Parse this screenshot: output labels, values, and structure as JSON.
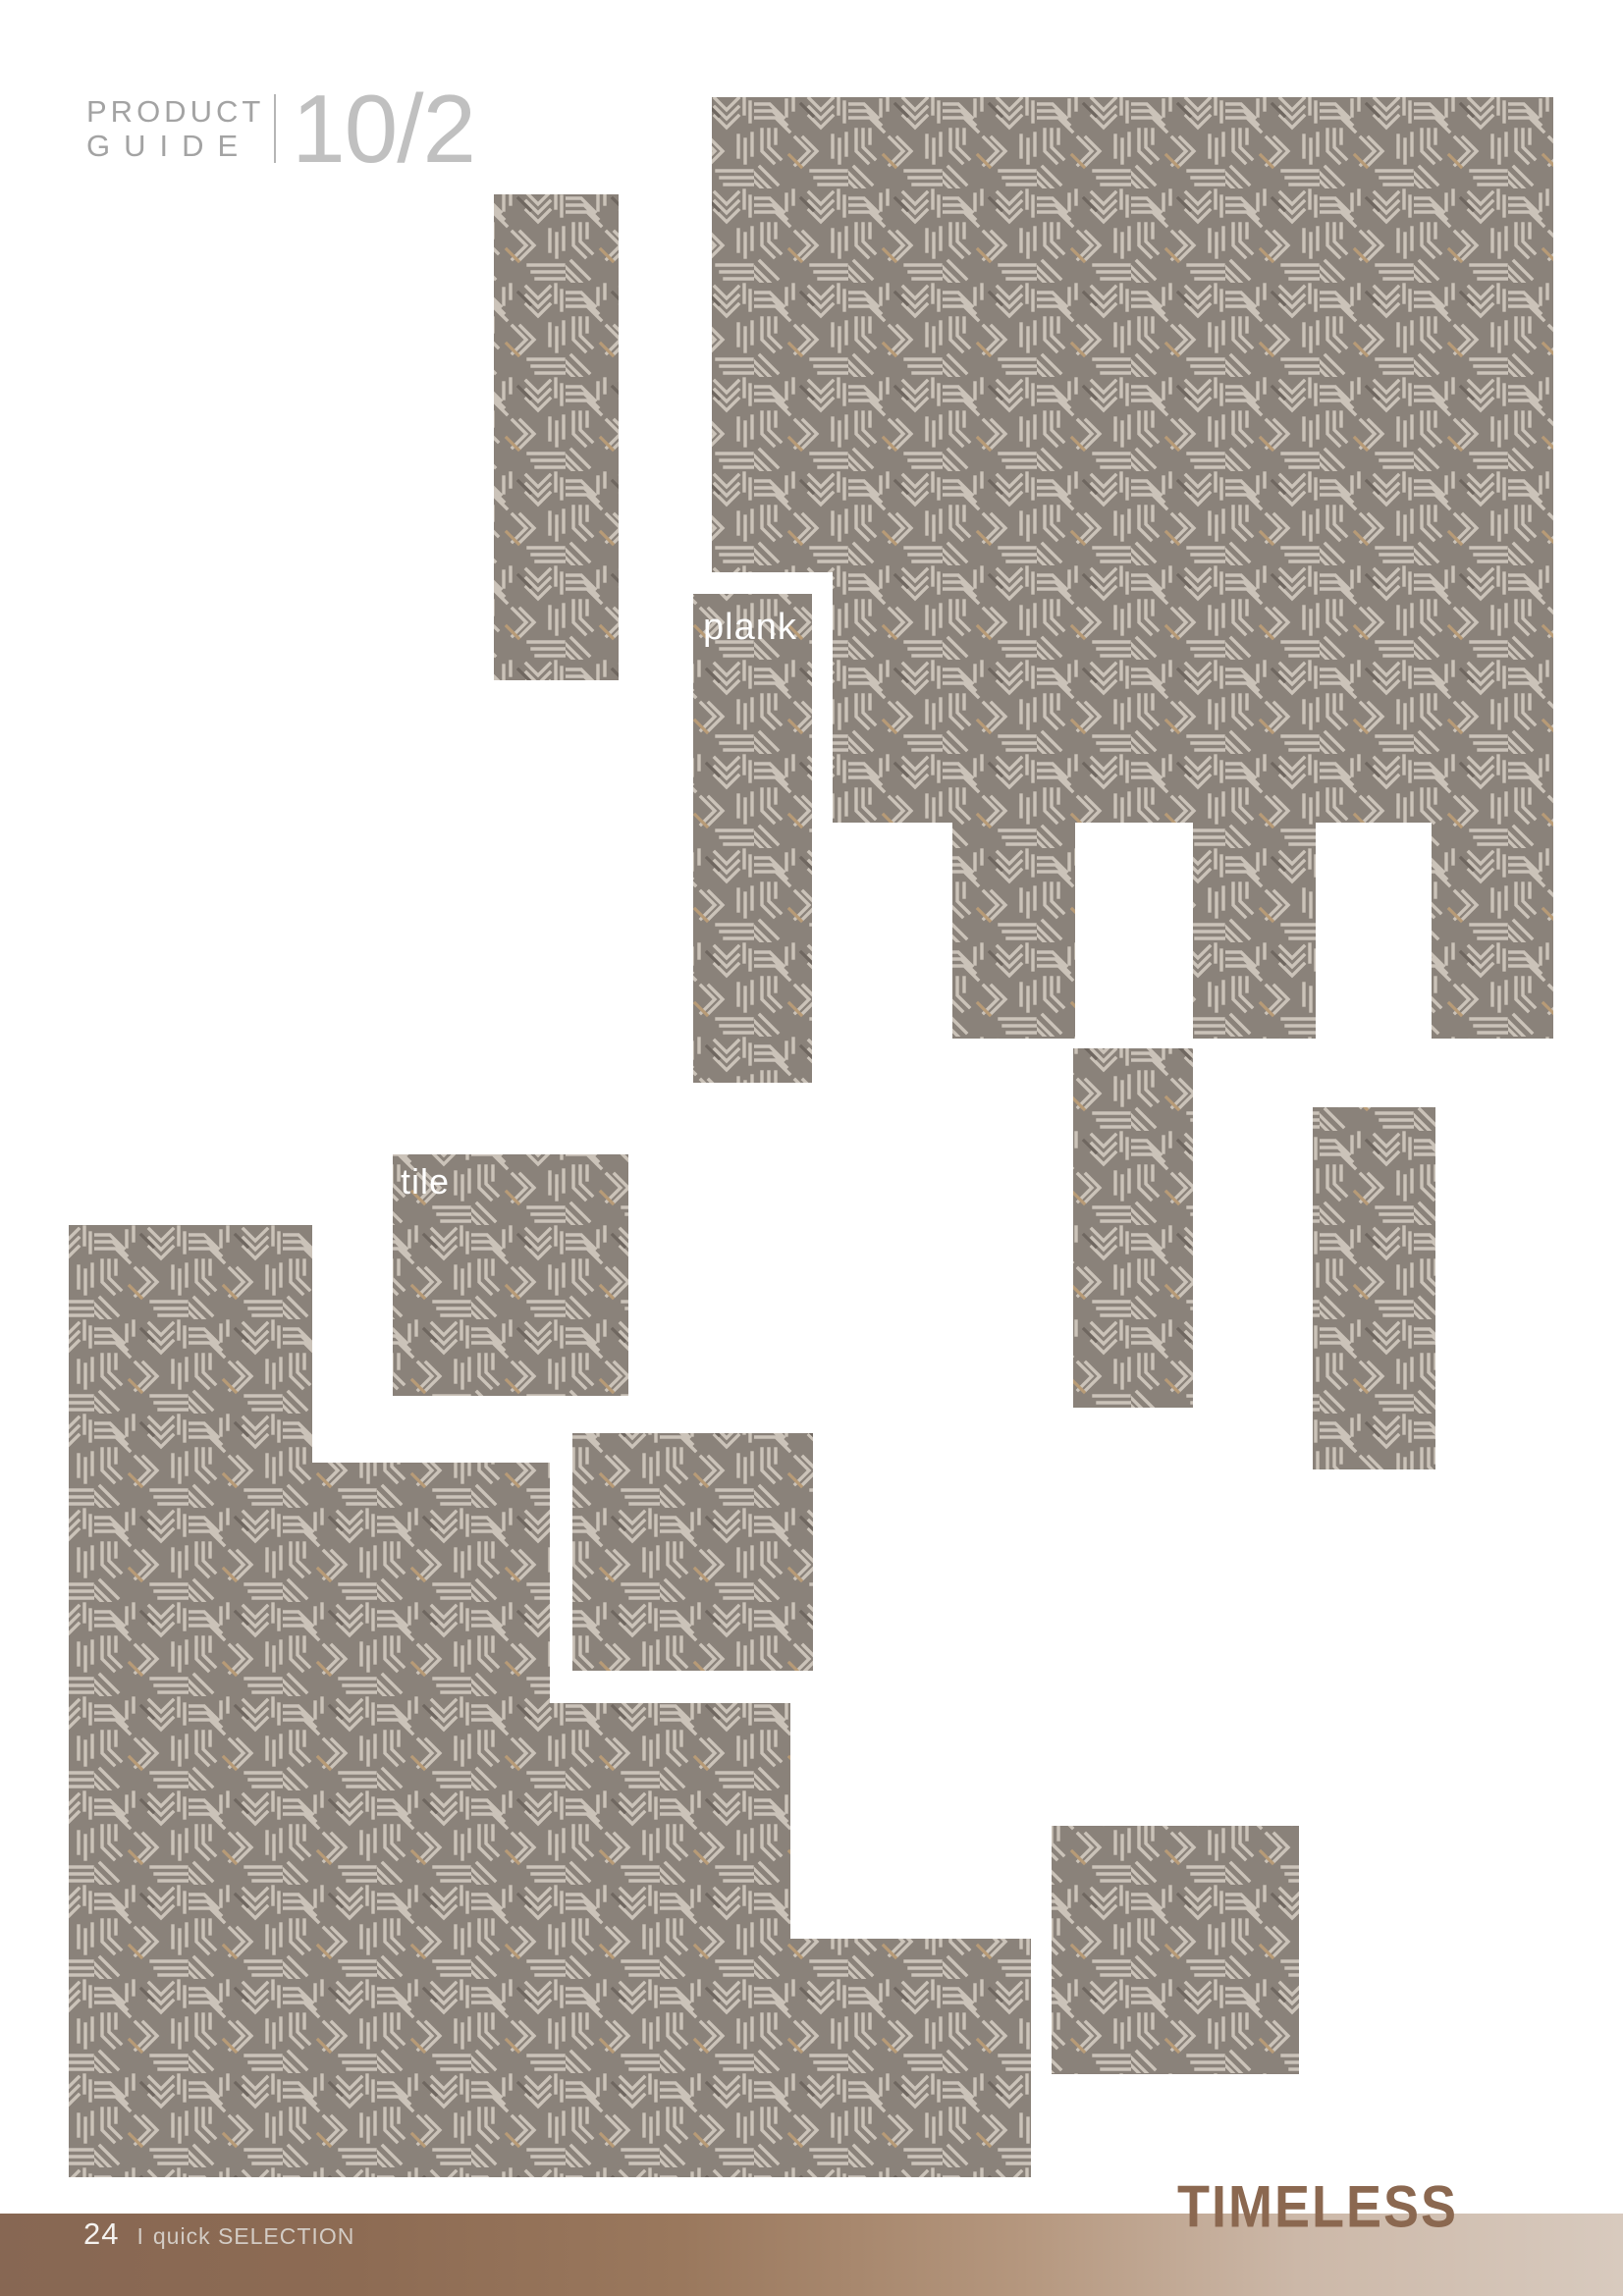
{
  "header": {
    "line1": "PRODUCT",
    "line2": "GUIDE",
    "issue": "10/2",
    "text_color": "#a3a3a3",
    "issue_color": "#c0c0c0"
  },
  "labels": {
    "plank": "plank",
    "tile": "tile",
    "label_color": "#ffffff"
  },
  "collage_colors": {
    "texture_base": "#8a827a",
    "texture_line": "#cbc3b9",
    "texture_accent": "#b89b76",
    "texture_shadow": "#6f6760"
  },
  "footer": {
    "page_number": "24",
    "separator": "I",
    "caption": "quick SELECTION",
    "brand": "TIMELESS",
    "brand_color": "#8b6850",
    "bar_gradient_left": "#876753",
    "bar_gradient_right": "#d8cabe"
  }
}
